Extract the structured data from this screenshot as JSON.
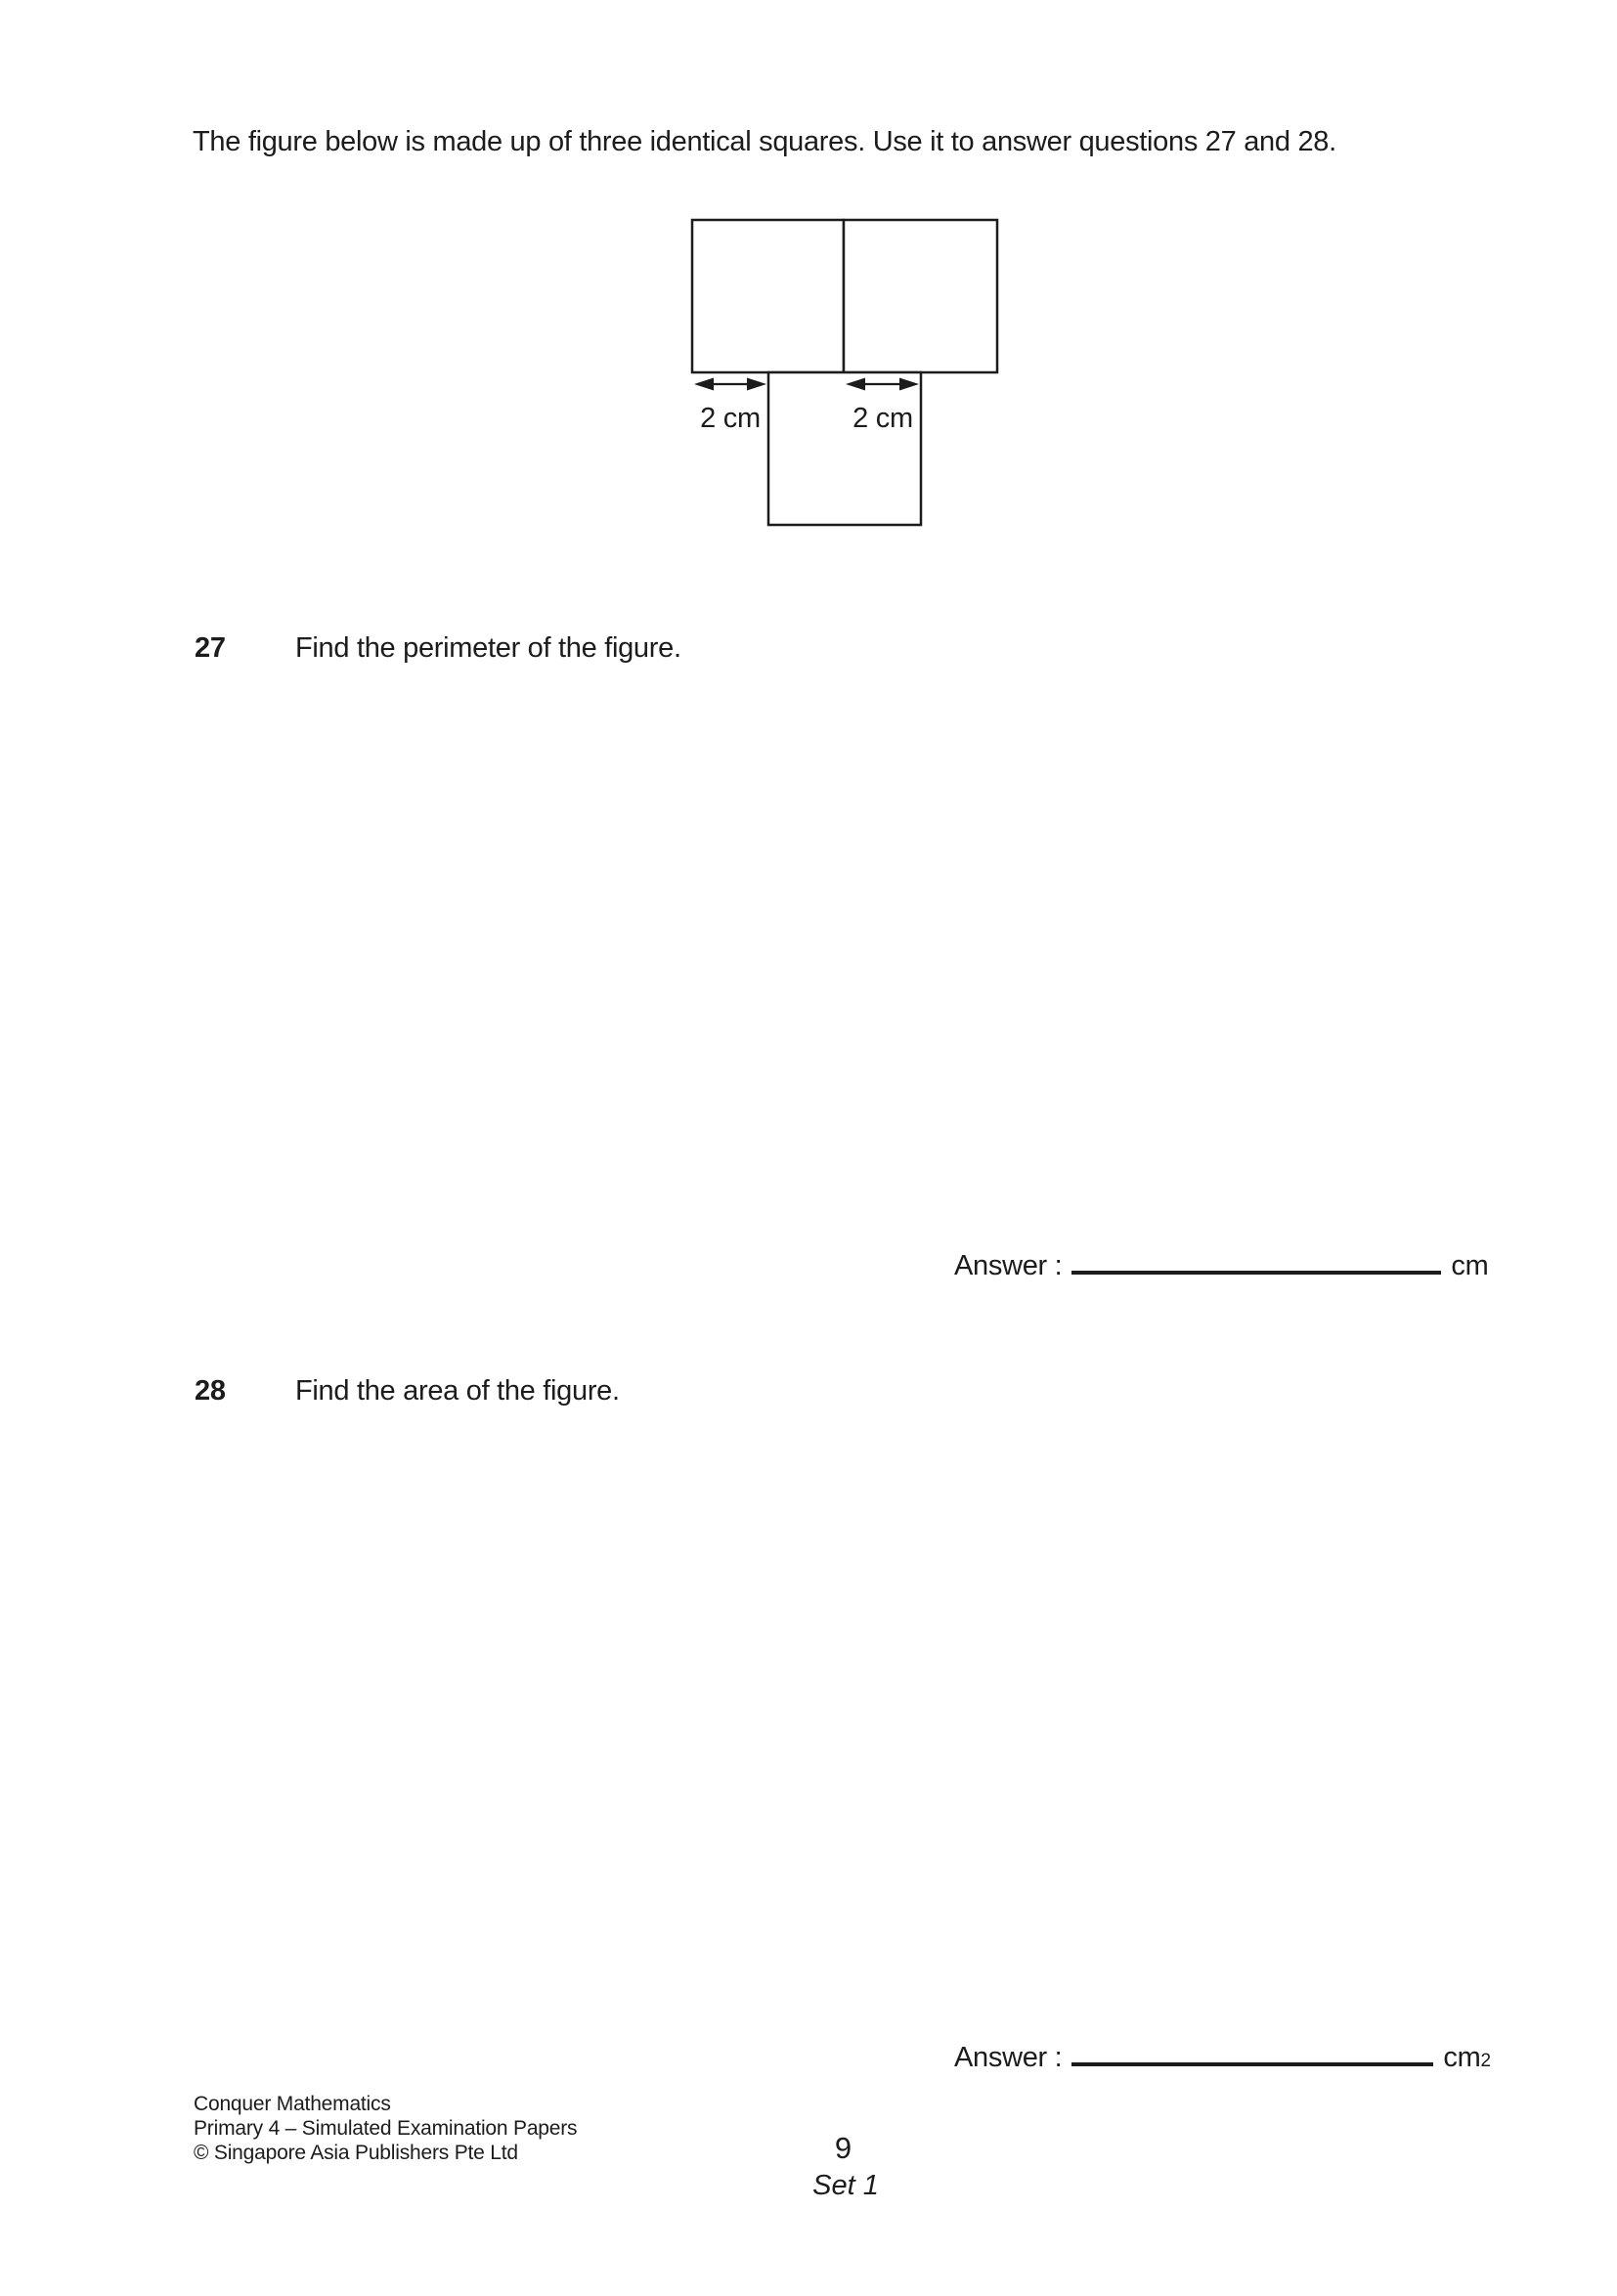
{
  "intro": "The figure below is made up of three identical squares. Use it to answer questions 27 and 28.",
  "figure": {
    "left_label": "2 cm",
    "right_label": "2 cm"
  },
  "questions": [
    {
      "number": "27",
      "text": "Find the perimeter of the figure.",
      "answer_label": "Answer :",
      "unit": "cm",
      "unit_sup": ""
    },
    {
      "number": "28",
      "text": "Find the area of the figure.",
      "answer_label": "Answer :",
      "unit": "cm",
      "unit_sup": "2"
    }
  ],
  "footer": {
    "lines": [
      "Conquer Mathematics",
      "Primary 4 – Simulated Examination Papers",
      "© Singapore Asia Publishers Pte Ltd"
    ],
    "page_number": "9",
    "set_label": "Set 1"
  },
  "colors": {
    "ink": "#1c1c1c",
    "paper": "#ffffff"
  }
}
